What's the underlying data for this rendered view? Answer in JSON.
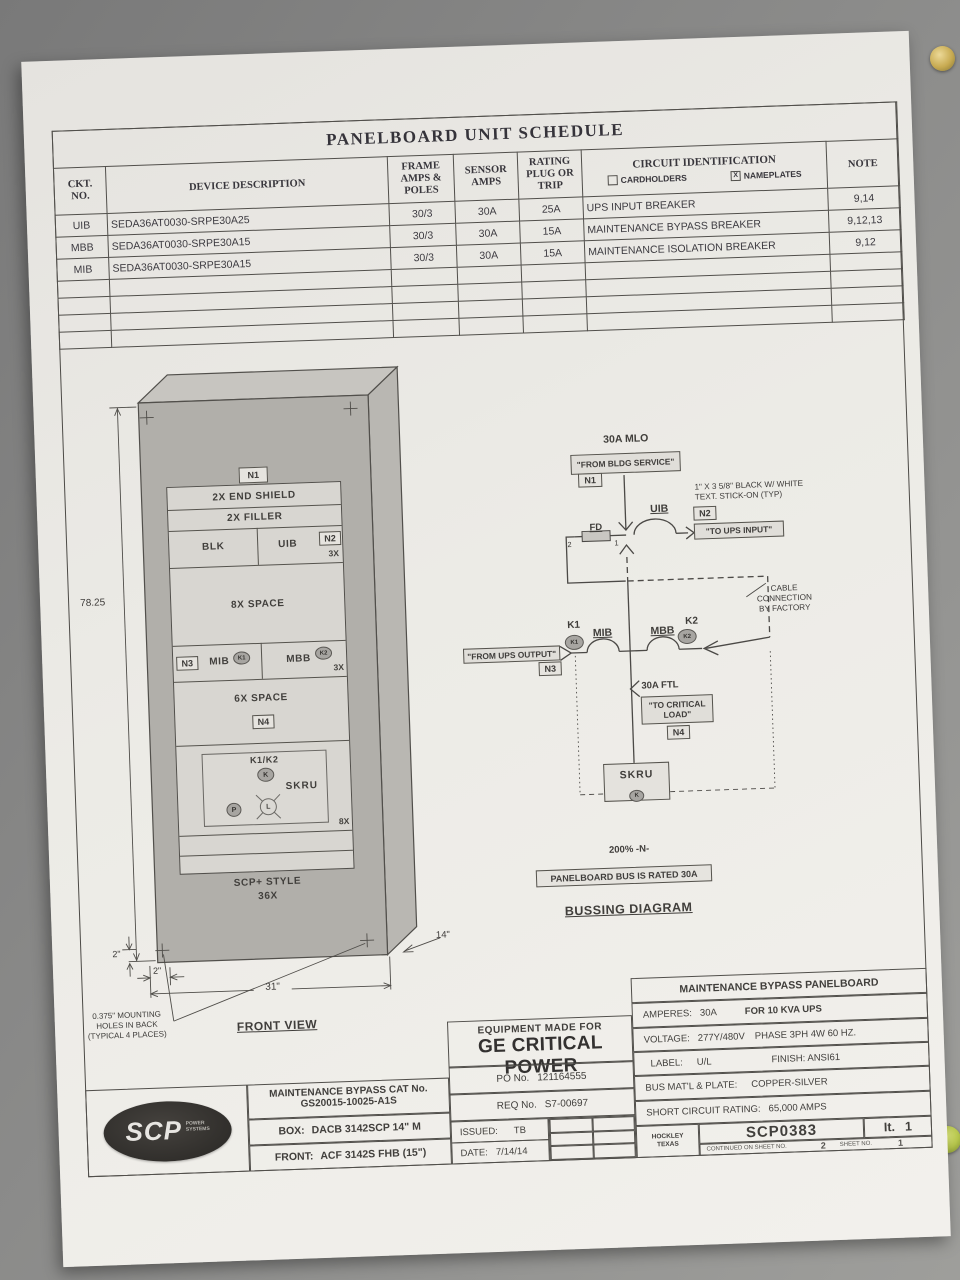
{
  "colors": {
    "background": "#8a8a88",
    "paper": "#ecebe6",
    "ink": "#3c3a38",
    "panel_gray": "#b1afab",
    "screw_brass": "#c8ab52",
    "screw_green": "#b9c94e"
  },
  "schedule": {
    "title": "PANELBOARD UNIT SCHEDULE",
    "headers": {
      "ckt": "CKT.\nNO.",
      "device": "DEVICE DESCRIPTION",
      "frame": "FRAME\nAMPS &\nPOLES",
      "sensor": "SENSOR\nAMPS",
      "rating": "RATING\nPLUG OR\nTRIP",
      "circuit": "CIRCUIT IDENTIFICATION",
      "cardholders": "CARDHOLDERS",
      "nameplates": "NAMEPLATES",
      "nameplates_mark": "X",
      "note": "NOTE"
    },
    "rows": [
      {
        "ckt": "UIB",
        "device": "SEDA36AT0030-SRPE30A25",
        "frame": "30/3",
        "sensor": "30A",
        "rating": "25A",
        "circuit": "UPS INPUT BREAKER",
        "note": "9,14"
      },
      {
        "ckt": "MBB",
        "device": "SEDA36AT0030-SRPE30A15",
        "frame": "30/3",
        "sensor": "30A",
        "rating": "15A",
        "circuit": "MAINTENANCE BYPASS BREAKER",
        "note": "9,12,13"
      },
      {
        "ckt": "MIB",
        "device": "SEDA36AT0030-SRPE30A15",
        "frame": "30/3",
        "sensor": "30A",
        "rating": "15A",
        "circuit": "MAINTENANCE ISOLATION BREAKER",
        "note": "9,12"
      }
    ]
  },
  "front_view": {
    "n1": "N1",
    "rows": {
      "end_shield_top": "2X END SHIELD",
      "filler_top": "2X FILLER",
      "blk": "BLK",
      "uib": "UIB",
      "n2": "N2",
      "qty_3x_top": "3X",
      "space_8x": "8X SPACE",
      "n3": "N3",
      "mib": "MIB",
      "k1": "K1",
      "mbb": "MBB",
      "k2": "K2",
      "qty_3x_bottom": "3X",
      "space_6x": "6X SPACE",
      "n4": "N4",
      "k1k2": "K1/K2",
      "k": "K",
      "skru": "SKRU",
      "p": "P",
      "l": "L",
      "qty_8x": "8X"
    },
    "style_note": "SCP+ STYLE\n36X",
    "dims": {
      "height": "78.25",
      "offset_v": "2\"",
      "offset_h": "2\"",
      "width": "31\"",
      "depth": "14\""
    },
    "mounting_note": "0.375\" MOUNTING\nHOLES IN BACK\n(TYPICAL 4 PLACES)",
    "caption": "FRONT VIEW"
  },
  "bussing": {
    "mlo": "30A MLO",
    "from_bldg": "\"FROM BLDG SERVICE\"",
    "n1": "N1",
    "uib": "UIB",
    "fd": "FD",
    "fd_term_2": "2",
    "fd_term_1": "1",
    "sticker_note": "1\" X 3 5/8\" BLACK W/ WHITE\nTEXT.   STICK-ON (TYP)",
    "n2": "N2",
    "to_ups": "\"TO UPS INPUT\"",
    "cable_note": "CABLE\nCONNECTION\nBY FACTORY",
    "k1": "K1",
    "mib": "MIB",
    "mbb": "MBB",
    "k2": "K2",
    "from_ups": "\"FROM UPS OUTPUT\"",
    "n3": "N3",
    "ftl": "30A FTL",
    "to_load": "\"TO CRITICAL\nLOAD\"",
    "n4": "N4",
    "skru": "SKRU",
    "k": "K",
    "neutral": "200% -N-",
    "bus_rating": "PANELBOARD BUS IS RATED 30A",
    "caption": "BUSSING DIAGRAM"
  },
  "title_block": {
    "panel_title": "MAINTENANCE BYPASS PANELBOARD",
    "amperes_label": "AMPERES:",
    "amperes_value": "30A",
    "ups_note": "FOR 10 KVA UPS",
    "voltage_label": "VOLTAGE:",
    "voltage_value": "277Y/480V",
    "phase": "PHASE 3PH 4W 60 HZ.",
    "label_label": "LABEL:",
    "label_value": "U/L",
    "finish": "FINISH: ANSI61",
    "bus_material_label": "BUS MAT'L & PLATE:",
    "bus_material_value": "COPPER-SILVER",
    "short_circuit_label": "SHORT CIRCUIT RATING:",
    "short_circuit_value": "65,000 AMPS",
    "equipment_made_for": "EQUIPMENT MADE FOR",
    "customer": "GE CRITICAL POWER",
    "po_label": "PO No.",
    "po_value": "121164555",
    "req_label": "REQ No.",
    "req_value": "S7-00697",
    "issued_label": "ISSUED:",
    "issued_value": "TB",
    "date_label": "DATE:",
    "date_value": "7/14/14",
    "location": "HOCKLEY\nTEXAS",
    "drawing_number": "SCP0383",
    "item_label": "It.",
    "item_value": "1",
    "continued_label": "CONTINUED ON SHEET NO.",
    "continued_value": "2",
    "sheet_label": "SHEET NO.",
    "sheet_value": "1",
    "logo_text": "SCP",
    "logo_sub": "POWER\nSYSTEMS",
    "cat_label": "MAINTENANCE BYPASS CAT No.",
    "cat_value": "GS20015-10025-A1S",
    "box_label": "BOX:",
    "box_value": "DACB 3142SCP 14\" M",
    "front_label": "FRONT:",
    "front_value": "ACF 3142S FHB (15\")"
  }
}
